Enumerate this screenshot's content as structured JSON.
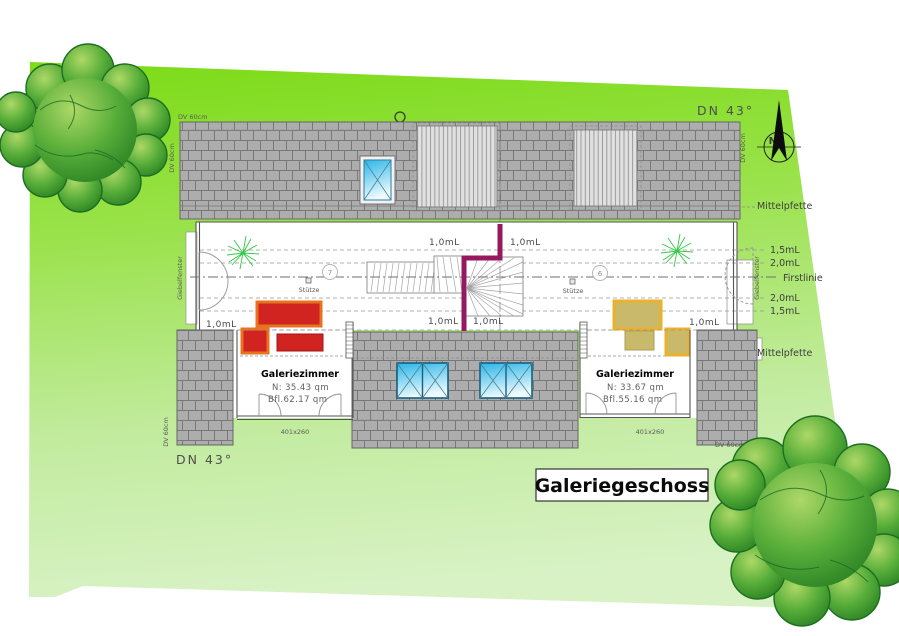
{
  "title": "Galeriegeschoss",
  "compass": {
    "north": "N"
  },
  "site": {
    "dn_top_right": "DN 43°",
    "dn_bottom_left": "DN 43°",
    "mittelpfette_top": "Mittelpfette",
    "mittelpfette_bottom": "Mittelpfette",
    "firstlinie": "Firstlinie",
    "levels": [
      "1,5mL",
      "2,0mL",
      "2,0mL",
      "1,5mL"
    ],
    "ml": [
      "1,0mL",
      "1,0mL",
      "1,0mL",
      "1,0mL",
      "1,0mL",
      "1,0mL"
    ],
    "giebelfenster_left": "Giebelfenster",
    "giebelfenster_right": "Giebelfenster",
    "dv_top_left_h": "DV 60cm",
    "dv_top_left_v": "DV 60cm",
    "dv_top_right_v": "DV 60cm",
    "dv_bottom_left_v": "DV 60cm",
    "dv_bottom_right_h": "DV 60cm"
  },
  "plan": {
    "stuetze_left": "Stütze",
    "stuetze_right": "Stütze",
    "position_left": "7",
    "position_right": "6",
    "rooms": [
      {
        "name": "Galeriezimmer",
        "net_area": "N: 35.43 qm",
        "floor_area": "Bfl.62.17 qm",
        "window_size": "401x260"
      },
      {
        "name": "Galeriezimmer",
        "net_area": "N: 33.67 qm",
        "floor_area": "Bfl.55.16 qm",
        "window_size": "401x260"
      }
    ]
  },
  "colors": {
    "site_green_top": "#7cdb16",
    "site_green_bottom": "#d8f2c6",
    "roof_gray": "#adadad",
    "dormer_stripe_gray": "#e0e0e0",
    "skylight_blue": "#29b5e8",
    "railing_magenta": "#96195f",
    "sofa_red": "#d12420",
    "sofa_red_trim": "#e8731e",
    "sofa_tan": "#c9b96a",
    "sofa_yellow_trim": "#edb02a",
    "tree_green": "#20781f",
    "plant_green": "#2fca45"
  }
}
